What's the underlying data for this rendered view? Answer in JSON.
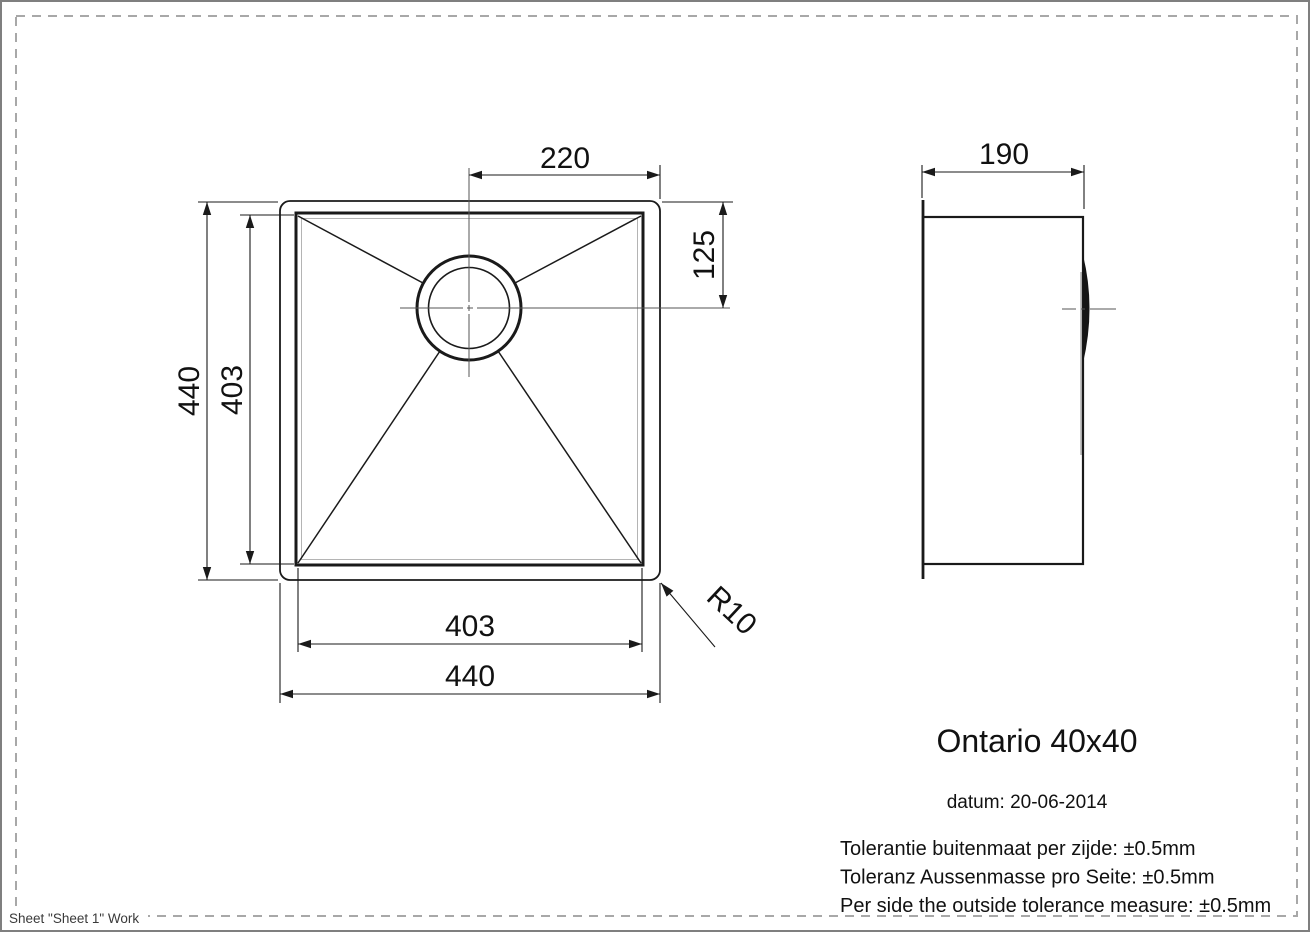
{
  "page": {
    "sheet_label": "Sheet \"Sheet 1\" Work"
  },
  "title_block": {
    "title": "Ontario 40x40",
    "date": "datum: 20-06-2014",
    "tolerances": [
      "Tolerantie buitenmaat per zijde: ±0.5mm",
      "Toleranz Aussenmasse pro Seite: ±0.5mm",
      "Per side the outside tolerance measure: ±0.5mm"
    ]
  },
  "dimensions": {
    "half_width": "220",
    "drain_offset": "125",
    "outer_height": "440",
    "bowl_height": "403",
    "bowl_width": "403",
    "outer_width": "440",
    "depth": "190",
    "corner_radius": "R10"
  },
  "colors": {
    "line": "#1a1a1a",
    "accent_gray": "#b4b4b4",
    "page_border": "#7f7f7f",
    "dashed_border": "#a8a8a8"
  }
}
